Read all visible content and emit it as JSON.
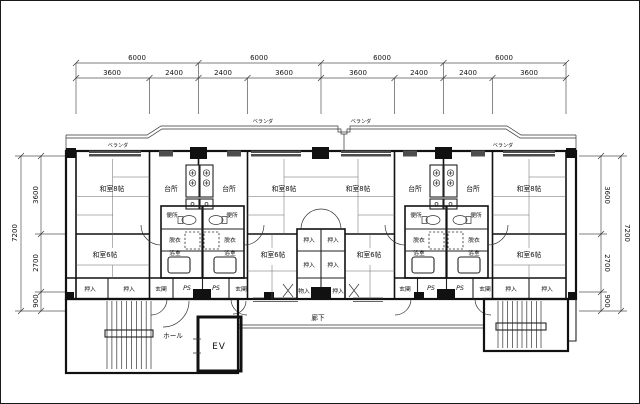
{
  "dimensions": {
    "top_major": [
      "6000",
      "6000",
      "6000",
      "6000"
    ],
    "top_minor": [
      "3600",
      "2400",
      "2400",
      "3600",
      "3600",
      "2400",
      "2400",
      "3600"
    ],
    "left": {
      "total": "7200",
      "segments": [
        "3600",
        "2700",
        "900"
      ]
    },
    "right": {
      "total": "7200",
      "segments": [
        "3600",
        "2700",
        "900"
      ]
    }
  },
  "labels": {
    "veranda": "ベランダ",
    "room8": "和室8帖",
    "room6": "和室6帖",
    "kitchen": "台所",
    "toilet": "便所",
    "dressing": "脱衣",
    "bath": "浴室",
    "closet": "押入",
    "storage": "物入",
    "entrance": "玄関",
    "pipe_space": "PS",
    "corridor": "廊下",
    "hall": "ホール",
    "elevator": "EV"
  }
}
